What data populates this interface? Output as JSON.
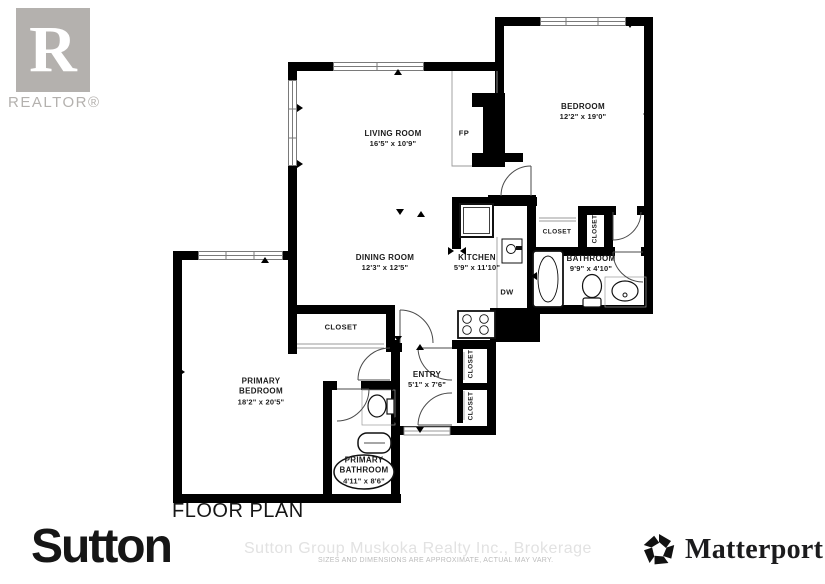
{
  "branding": {
    "realtor_r": "R",
    "realtor_text": "REALTOR®",
    "sutton": "Sutton",
    "matterport": "Matterport",
    "matterport_reg": "®"
  },
  "title": "FLOOR PLAN",
  "watermark": {
    "line1": "Sutton Group Muskoka Realty Inc., Brokerage",
    "line2": "SIZES AND DIMENSIONS ARE APPROXIMATE, ACTUAL MAY VARY."
  },
  "labels": {
    "closet": "CLOSET",
    "fireplace": "FP",
    "dishwasher": "DW"
  },
  "rooms": [
    {
      "name": "LIVING ROOM",
      "dims": "16'5\" x 10'9\""
    },
    {
      "name": "BEDROOM",
      "dims": "12'2\" x 19'0\""
    },
    {
      "name": "DINING ROOM",
      "dims": "12'3\" x 12'5\""
    },
    {
      "name": "KITCHEN",
      "dims": "5'9\" x 11'10\""
    },
    {
      "name": "BATHROOM",
      "dims": "9'9\" x 4'10\""
    },
    {
      "name": "PRIMARY BEDROOM",
      "dims": "18'2\" x 20'5\""
    },
    {
      "name": "ENTRY",
      "dims": "5'1\" x 7'6\""
    },
    {
      "name": "PRIMARY BATHROOM",
      "dims": "4'11\" x 8'6\""
    }
  ]
}
